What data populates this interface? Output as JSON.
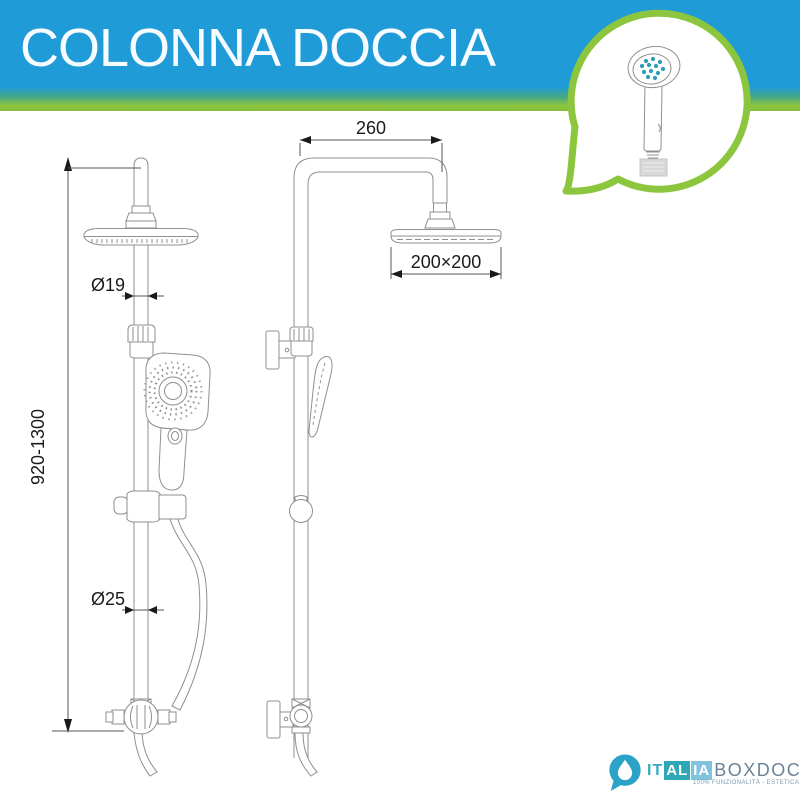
{
  "banner": {
    "title": "COLONNA DOCCIA"
  },
  "diagram": {
    "views": [
      "front",
      "side"
    ],
    "dimensions": {
      "height_range": "920-1300",
      "pipe_diameter": "Ø19",
      "column_diameter": "Ø25",
      "arm_length": "260",
      "head_size": "200×200"
    }
  },
  "bubble": {
    "icon": "handshower-icon"
  },
  "logo": {
    "part1": "IT",
    "part2": "AL",
    "part3": "IA",
    "part4": "BOXDOCCIA",
    "tagline": "100% FUNZIONALITÀ - ESTETICA - PRATICITÀ"
  },
  "colors": {
    "banner_blue": "#1F9BD7",
    "banner_green": "#8DC63F",
    "bubble_border": "#8CC63E",
    "drawing_line": "#8F8F8F",
    "dimension_ink": "#1A1A1A",
    "nozzle_teal": "#2D9DB8",
    "logo_teal": "#2BA3C8",
    "logo_box_teal": "#2EA7B7",
    "logo_box_blue": "#7FC3DC",
    "logo_gray": "#6B8398"
  }
}
